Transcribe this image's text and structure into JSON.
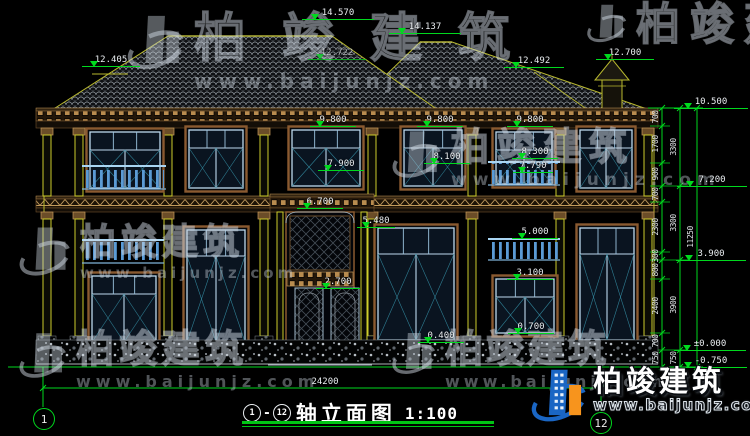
{
  "brand": {
    "name": "柏竣建筑",
    "url": "www.baijunjz.com"
  },
  "title_bar": {
    "axis_from": "1",
    "dash": "-",
    "axis_to": "12",
    "name": "轴立面图",
    "scale": "1:100"
  },
  "axis_bubbles": {
    "left": "1",
    "right": "12"
  },
  "total_width_dim": "24200",
  "elevation_markers": [
    {
      "label": "14.570",
      "x": 338,
      "y": 8,
      "w": 72
    },
    {
      "label": "14.137",
      "x": 425,
      "y": 22,
      "w": 72
    },
    {
      "label": "12.405",
      "x": 111,
      "y": 55,
      "w": 58
    },
    {
      "label": "12.722",
      "x": 337,
      "y": 48,
      "w": 58,
      "faint": true
    },
    {
      "label": "12.492",
      "x": 534,
      "y": 56,
      "w": 60
    },
    {
      "label": "12.700",
      "x": 625,
      "y": 48,
      "w": 58
    },
    {
      "label": "10.500",
      "x": 711,
      "y": 97,
      "w": 74
    },
    {
      "label": "7.200",
      "x": 712,
      "y": 175,
      "w": 70
    },
    {
      "label": "3.900",
      "x": 711,
      "y": 249,
      "w": 70
    },
    {
      "label": "±0.000",
      "x": 710,
      "y": 339,
      "w": 72
    },
    {
      "label": "-0.750",
      "x": 711,
      "y": 356,
      "w": 72
    },
    {
      "label": "9.800",
      "x": 333,
      "y": 115,
      "w": 46
    },
    {
      "label": "9.800",
      "x": 440,
      "y": 115,
      "w": 46
    },
    {
      "label": "9.800",
      "x": 530,
      "y": 115,
      "w": 46
    },
    {
      "label": "7.900",
      "x": 341,
      "y": 159,
      "w": 46
    },
    {
      "label": "8.100",
      "x": 447,
      "y": 152,
      "w": 46
    },
    {
      "label": "8.300",
      "x": 535,
      "y": 147,
      "w": 46
    },
    {
      "label": "7.790",
      "x": 533,
      "y": 161,
      "w": 40
    },
    {
      "label": "6.700",
      "x": 320,
      "y": 197,
      "w": 46
    },
    {
      "label": "5.480",
      "x": 376,
      "y": 216,
      "w": 38
    },
    {
      "label": "5.000",
      "x": 535,
      "y": 227,
      "w": 46
    },
    {
      "label": "3.100",
      "x": 530,
      "y": 268,
      "w": 46
    },
    {
      "label": "2.700",
      "x": 338,
      "y": 277,
      "w": 44
    },
    {
      "label": "0.400",
      "x": 441,
      "y": 331,
      "w": 46
    },
    {
      "label": "0.700",
      "x": 531,
      "y": 322,
      "w": 46
    }
  ],
  "dim_chains": [
    {
      "x": 656,
      "labels": [
        {
          "t": "700",
          "y": 117
        },
        {
          "t": "1700",
          "y": 144
        },
        {
          "t": "900",
          "y": 174
        },
        {
          "t": "700",
          "y": 194
        },
        {
          "t": "2300",
          "y": 227
        },
        {
          "t": "300",
          "y": 256
        },
        {
          "t": "800",
          "y": 270
        },
        {
          "t": "2400",
          "y": 306
        },
        {
          "t": "700",
          "y": 341
        },
        {
          "t": "750",
          "y": 358
        }
      ]
    },
    {
      "x": 674,
      "labels": [
        {
          "t": "3300",
          "y": 147
        },
        {
          "t": "3300",
          "y": 223
        },
        {
          "t": "3900",
          "y": 305
        },
        {
          "t": "750",
          "y": 358
        }
      ]
    },
    {
      "x": 691,
      "labels": [
        {
          "t": "11250",
          "y": 237
        }
      ]
    }
  ]
}
